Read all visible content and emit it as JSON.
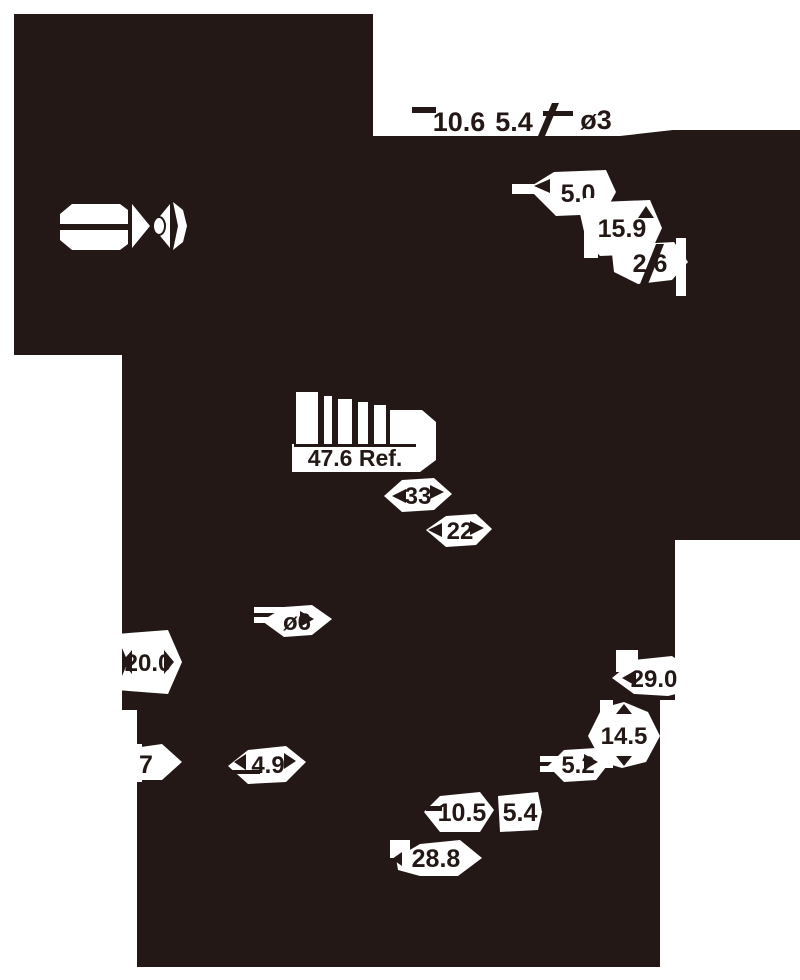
{
  "colors": {
    "ink": "#231815",
    "paper": "#ffffff"
  },
  "labels": {
    "top": {
      "len": "10.6",
      "offset": "5.4",
      "dia": "ø3"
    },
    "right_top": {
      "a": "5.0",
      "b": "15.9",
      "c": "2.6"
    },
    "middle": {
      "ref": "47.6 Ref.",
      "l33": "33",
      "l22": "22",
      "dia": "ø6"
    },
    "left": {
      "h": "20.0",
      "seven": "7",
      "w": "4.9"
    },
    "right_bottom": {
      "a": "29.0",
      "b": "14.5",
      "c": "5.2"
    },
    "bottom": {
      "a": "10.5",
      "b": "5.4",
      "c": "28.8"
    }
  }
}
